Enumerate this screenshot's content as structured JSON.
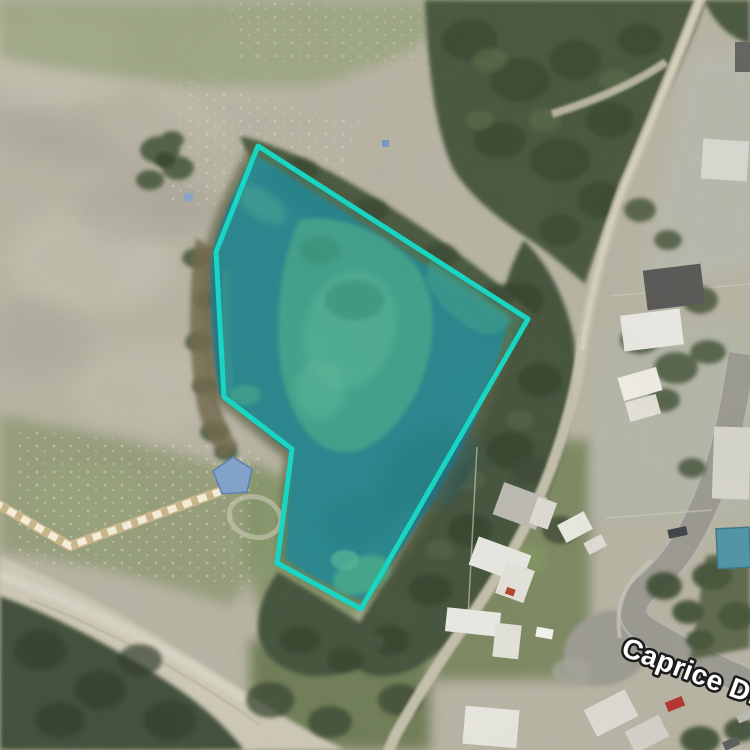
{
  "map": {
    "view_kind": "satellite-aerial",
    "street_label": "Caprice Dr",
    "parcel": {
      "points": "258,146 528,319 361,609 277,563 292,449 224,397 216,252",
      "stroke_color": "#17d7c4",
      "fill_color": "rgba(43,217,194,0.16)",
      "stroke_width": "5"
    },
    "label": {
      "fill": "#ffffff",
      "halo": "#1c1c1c"
    },
    "water_color": "#2a7381"
  }
}
